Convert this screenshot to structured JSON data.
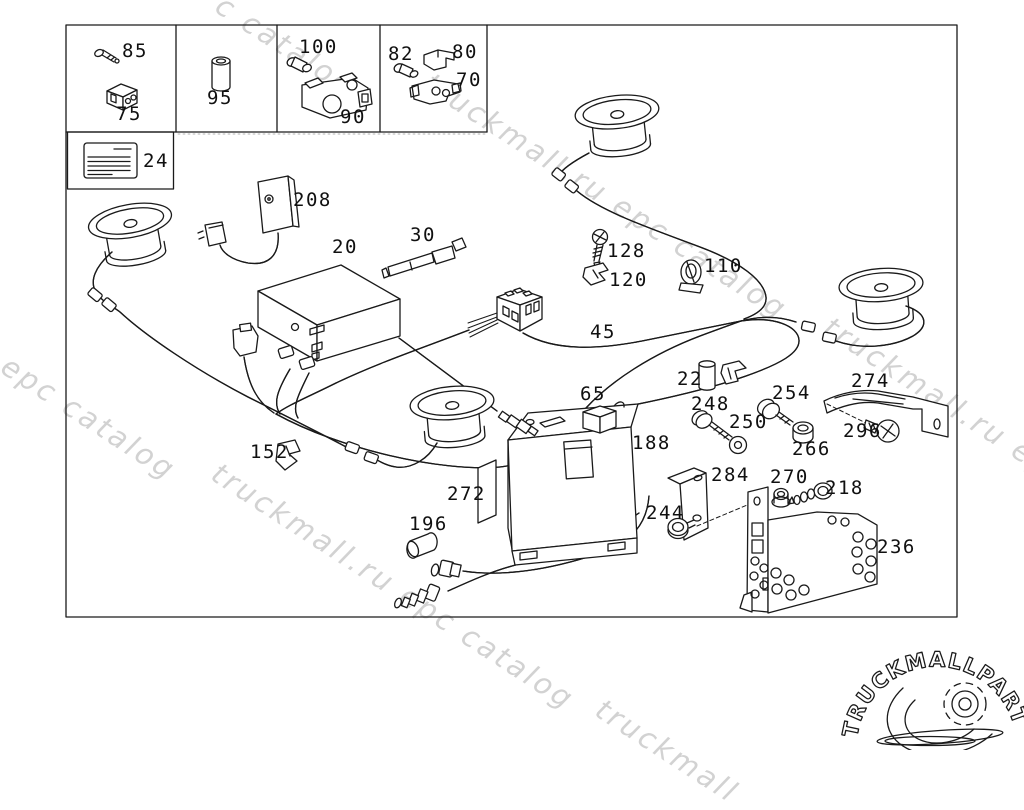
{
  "diagram": {
    "description": "car audio system exploded parts diagram",
    "code_card_label": "CODE",
    "part_labels": [
      {
        "num": "85",
        "x": 122,
        "y": 42
      },
      {
        "num": "75",
        "x": 116,
        "y": 105
      },
      {
        "num": "95",
        "x": 207,
        "y": 89
      },
      {
        "num": "100",
        "x": 299,
        "y": 38
      },
      {
        "num": "90",
        "x": 340,
        "y": 108
      },
      {
        "num": "82",
        "x": 388,
        "y": 45
      },
      {
        "num": "80",
        "x": 452,
        "y": 43
      },
      {
        "num": "70",
        "x": 456,
        "y": 71
      },
      {
        "num": "24",
        "x": 143,
        "y": 152
      },
      {
        "num": "208",
        "x": 293,
        "y": 191
      },
      {
        "num": "20",
        "x": 332,
        "y": 238
      },
      {
        "num": "30",
        "x": 410,
        "y": 226
      },
      {
        "num": "128",
        "x": 607,
        "y": 242
      },
      {
        "num": "120",
        "x": 609,
        "y": 271
      },
      {
        "num": "110",
        "x": 704,
        "y": 257
      },
      {
        "num": "45",
        "x": 590,
        "y": 323
      },
      {
        "num": "65",
        "x": 580,
        "y": 385
      },
      {
        "num": "22",
        "x": 677,
        "y": 370
      },
      {
        "num": "248",
        "x": 691,
        "y": 395
      },
      {
        "num": "250",
        "x": 729,
        "y": 413
      },
      {
        "num": "254",
        "x": 772,
        "y": 384
      },
      {
        "num": "266",
        "x": 792,
        "y": 440
      },
      {
        "num": "274",
        "x": 851,
        "y": 372
      },
      {
        "num": "296",
        "x": 843,
        "y": 422
      },
      {
        "num": "284",
        "x": 711,
        "y": 466
      },
      {
        "num": "244",
        "x": 646,
        "y": 504
      },
      {
        "num": "270",
        "x": 770,
        "y": 468
      },
      {
        "num": "218",
        "x": 825,
        "y": 479
      },
      {
        "num": "236",
        "x": 877,
        "y": 538
      },
      {
        "num": "188",
        "x": 632,
        "y": 434
      },
      {
        "num": "272",
        "x": 447,
        "y": 485
      },
      {
        "num": "196",
        "x": 409,
        "y": 515
      },
      {
        "num": "152",
        "x": 250,
        "y": 443
      }
    ]
  },
  "watermarks": [
    {
      "text": "c catalog",
      "x": 228,
      "y": -12
    },
    {
      "text": "truckmall.ru epc catalog",
      "x": 437,
      "y": 66
    },
    {
      "text": "truckmall.ru epc catalog",
      "x": 836,
      "y": 310
    },
    {
      "text": "l epc catalog",
      "x": -6,
      "y": 336
    },
    {
      "text": "truckmall.ru epc catalog",
      "x": 224,
      "y": 456
    },
    {
      "text": "truckmall",
      "x": 608,
      "y": 692
    }
  ],
  "logo": {
    "text_gray": "TRUCKMALL",
    "text_pink": "PARTS"
  },
  "colors": {
    "line": "#1a1a1a",
    "watermark": "#c7c7c7",
    "logo_gray": "#9b9b9b",
    "logo_pink": "#e4708d"
  }
}
